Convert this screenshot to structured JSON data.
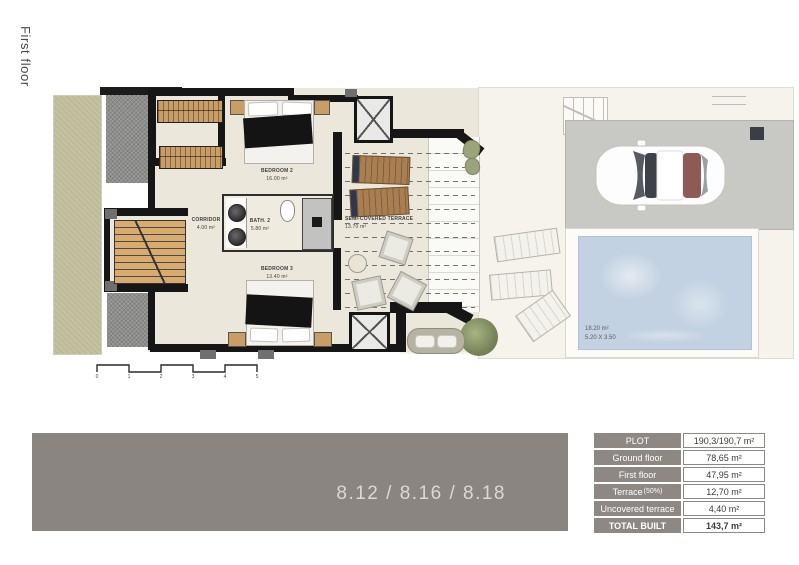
{
  "page": {
    "floor_label": "First floor"
  },
  "plan": {
    "rooms": [
      {
        "name": "BEDROOM 2",
        "area": "16.00 m²"
      },
      {
        "name": "CORRIDOR",
        "area": "4.00 m²"
      },
      {
        "name": "BATH. 2",
        "area": "5.80 m²"
      },
      {
        "name": "SEMI-COVERED TERRACE",
        "area": "13.70 m²"
      },
      {
        "name": "BEDROOM 3",
        "area": "13.40 m²"
      }
    ],
    "pool": {
      "area": "18.20 m²",
      "dimensions": "5.20 X 3.50"
    },
    "scale_ticks": [
      "0",
      "1",
      "2",
      "3",
      "4",
      "5"
    ]
  },
  "banner": {
    "units_label": "8.12 / 8.16 / 8.18"
  },
  "summary_table": {
    "rows": [
      {
        "label": "PLOT",
        "value": "190,3/190,7 m²"
      },
      {
        "label": "Ground floor",
        "value": "78,65 m²"
      },
      {
        "label": "First floor",
        "value": "47,95 m²"
      },
      {
        "label": "Terrace",
        "label_suffix": "(50%)",
        "value": "12,70 m²"
      },
      {
        "label": "Uncovered terrace",
        "value": "4,40 m²"
      },
      {
        "label": "TOTAL BUILT",
        "value": "143,7 m²"
      }
    ]
  },
  "colors": {
    "wall": "#161616",
    "floor": "#ece7db",
    "garden": "#bdbb97",
    "gravel": "#8e8e8c",
    "pool": "#c3d2e2",
    "parking": "#c8c8c5",
    "wood": "#c99d66",
    "banner_bg": "#8a8581",
    "banner_text": "#dcd8d4",
    "table_label_bg": "#8d8884",
    "table_value_text": "#3a3a3a"
  }
}
